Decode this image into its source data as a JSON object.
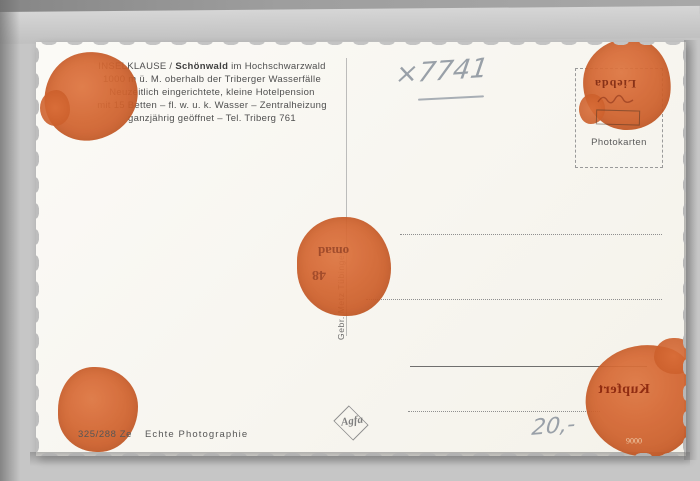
{
  "colors": {
    "blob_orange": "#d06030",
    "pencil_gray": "#99a0a8",
    "ghost_ink_red": "#7d2812",
    "card_white": "#faf9f5",
    "background_gray": "#c6c6c6"
  },
  "postcard": {
    "info_block": {
      "line1_prefix": "INSELKLAUSE / ",
      "line1_bold": "Schönwald",
      "line1_suffix": " im Hochschwarzwald",
      "line2": "1000 m ü. M. oberhalb der Triberger Wasserfälle",
      "line3": "Neuzeitlich eingerichtete, kleine Hotelpension",
      "line4": "mit 15 Betten – fl. w. u. k. Wasser – Zentralheizung",
      "line5": "ganzjährig geöffnet – Tel. Triberg 761"
    },
    "handwriting": {
      "catalog_number": "×7741",
      "price": "20,-"
    },
    "publisher_vertical": "Gebr. Metz Tübingen",
    "stamp_box": {
      "label": "Photokarten"
    },
    "ghost_prints": {
      "stamp_area_upside_down": "Liebda",
      "center_upside_down_line1": "omad",
      "center_upside_down_line2": "48",
      "bottom_right_mirrored": "Kupfert",
      "bottom_right_negative_number": "0006"
    },
    "imprint": {
      "number": "325/288 Ze",
      "label": "Echte Photographie"
    },
    "logo": {
      "brand": "Agfa"
    }
  }
}
